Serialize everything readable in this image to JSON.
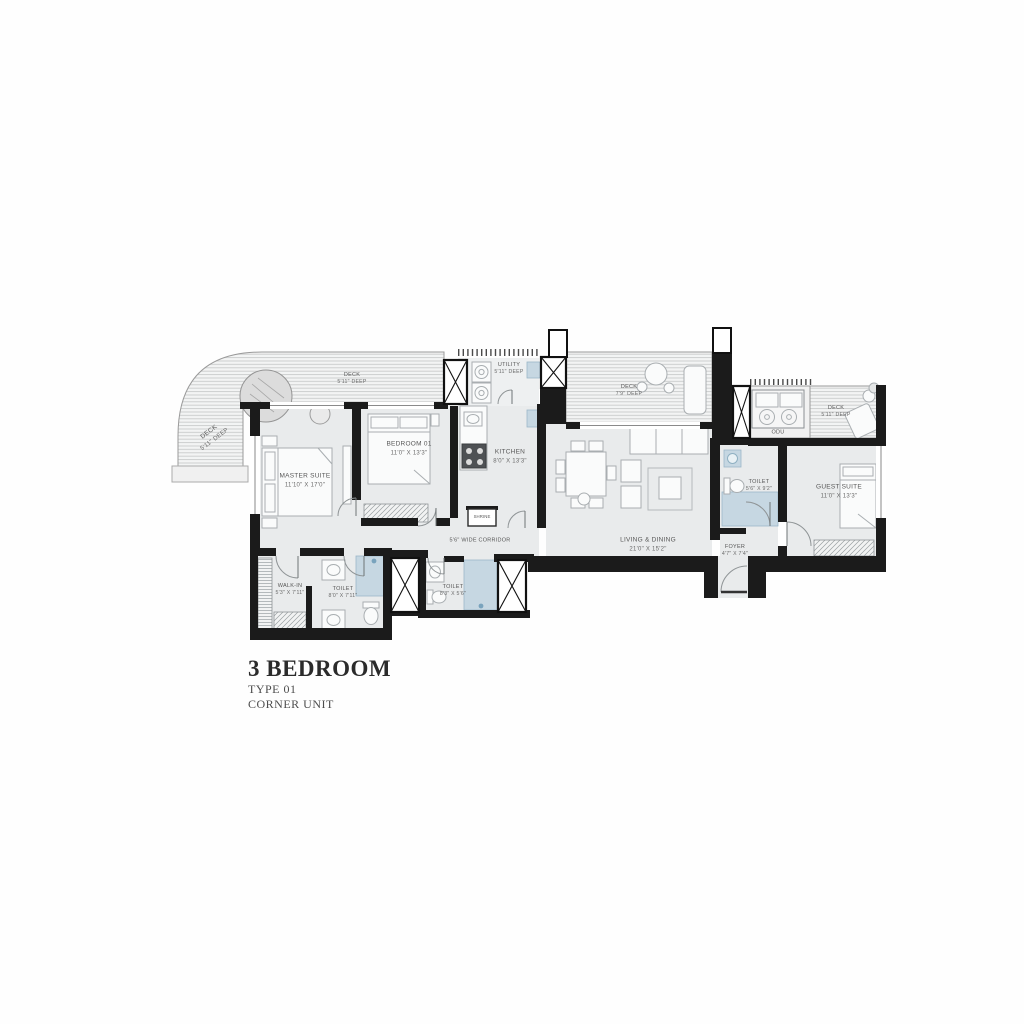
{
  "title_block": {
    "title": "3 BEDROOM",
    "type_line": "TYPE 01",
    "unit_line": "CORNER UNIT"
  },
  "rooms": {
    "deck_left": {
      "name": "DECK",
      "dims": "5'11\" DEEP"
    },
    "deck_top": {
      "name": "DECK",
      "dims": "5'11\" DEEP"
    },
    "utility": {
      "name": "UTILITY",
      "dims": "5'11\" DEEP"
    },
    "deck_mid": {
      "name": "DECK",
      "dims": "7'9\" DEEP"
    },
    "odu": {
      "name": "ODU"
    },
    "deck_right": {
      "name": "DECK",
      "dims": "5'11\" DEEP"
    },
    "master": {
      "name": "MASTER SUITE",
      "dims": "11'10\" X 17'0\""
    },
    "bedroom01": {
      "name": "BEDROOM 01",
      "dims": "11'0\" X 13'3\""
    },
    "kitchen": {
      "name": "KITCHEN",
      "dims": "8'0\" X 13'3\""
    },
    "living": {
      "name": "LIVING & DINING",
      "dims": "21'0\" X 15'2\""
    },
    "corridor": {
      "name": "5'6\" WIDE CORRIDOR"
    },
    "shrine": {
      "name": "SHRINE"
    },
    "foyer": {
      "name": "FOYER",
      "dims": "4'7\" X 7'4\""
    },
    "toilet_guest": {
      "name": "TOILET",
      "dims": "5'6\" X 9'2\""
    },
    "guest": {
      "name": "GUEST SUITE",
      "dims": "11'0\" X 13'3\""
    },
    "walkin": {
      "name": "WALK-IN",
      "dims": "5'3\" X 7'11\""
    },
    "toilet_master": {
      "name": "TOILET",
      "dims": "8'0\" X 7'11\""
    },
    "toilet_common": {
      "name": "TOILET",
      "dims": "8'3\" X 5'6\""
    }
  },
  "colors": {
    "wall": "#1b1b1b",
    "floor": "#e9ebec",
    "deck_line": "#c9cbcb",
    "wet_area": "#c6d7e2",
    "label_text": "#575757",
    "title_text": "#2b2b2b"
  }
}
